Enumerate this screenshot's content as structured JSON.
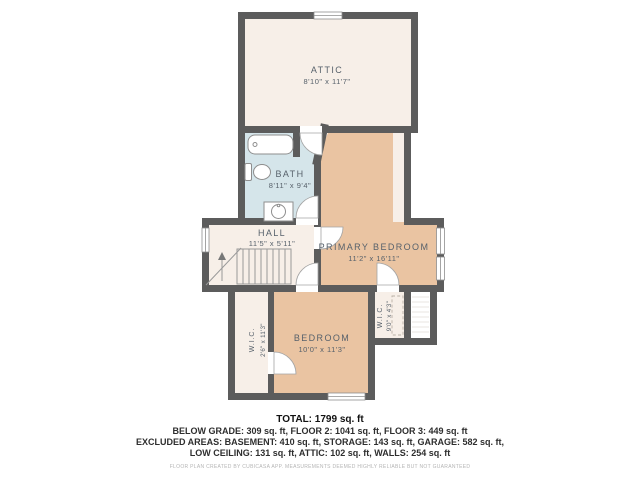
{
  "floor_plan": {
    "rooms": {
      "attic": {
        "label": "ATTIC",
        "dimensions": "8'10\" x 11'7\""
      },
      "bath": {
        "label": "BATH",
        "dimensions": "8'11\" x 9'4\""
      },
      "hall": {
        "label": "HALL",
        "dimensions": "11'5\" x 5'11\""
      },
      "primary_bedroom": {
        "label": "PRIMARY BEDROOM",
        "dimensions": "11'2\" x 16'11\""
      },
      "bedroom": {
        "label": "BEDROOM",
        "dimensions": "10'0\" x 11'3\""
      },
      "wic_left": {
        "label": "W.I.C.",
        "dimensions": "2'6\" x 11'3\""
      },
      "wic_right": {
        "label": "W.I.C.",
        "dimensions": "9'0\" x 4'3\""
      }
    },
    "colors": {
      "wall": "#5c5c5c",
      "room_cream": "#f7efe8",
      "room_blue": "#d5e5ea",
      "room_tan": "#eac4a2",
      "label_text": "#57616b"
    }
  },
  "summary": {
    "total": "TOTAL: 1799 sq. ft",
    "line_floors": "BELOW GRADE: 309 sq. ft, FLOOR 2: 1041 sq. ft, FLOOR 3: 449 sq. ft",
    "line_excluded": "EXCLUDED AREAS: BASEMENT: 410 sq. ft, STORAGE: 143 sq. ft, GARAGE: 582 sq. ft,",
    "line_excluded2": "LOW CEILING: 131 sq. ft, ATTIC: 102 sq. ft, WALLS: 254 sq. ft",
    "disclaimer": "FLOOR PLAN CREATED BY CUBICASA APP. MEASUREMENTS DEEMED HIGHLY RELIABLE BUT NOT GUARANTEED"
  }
}
